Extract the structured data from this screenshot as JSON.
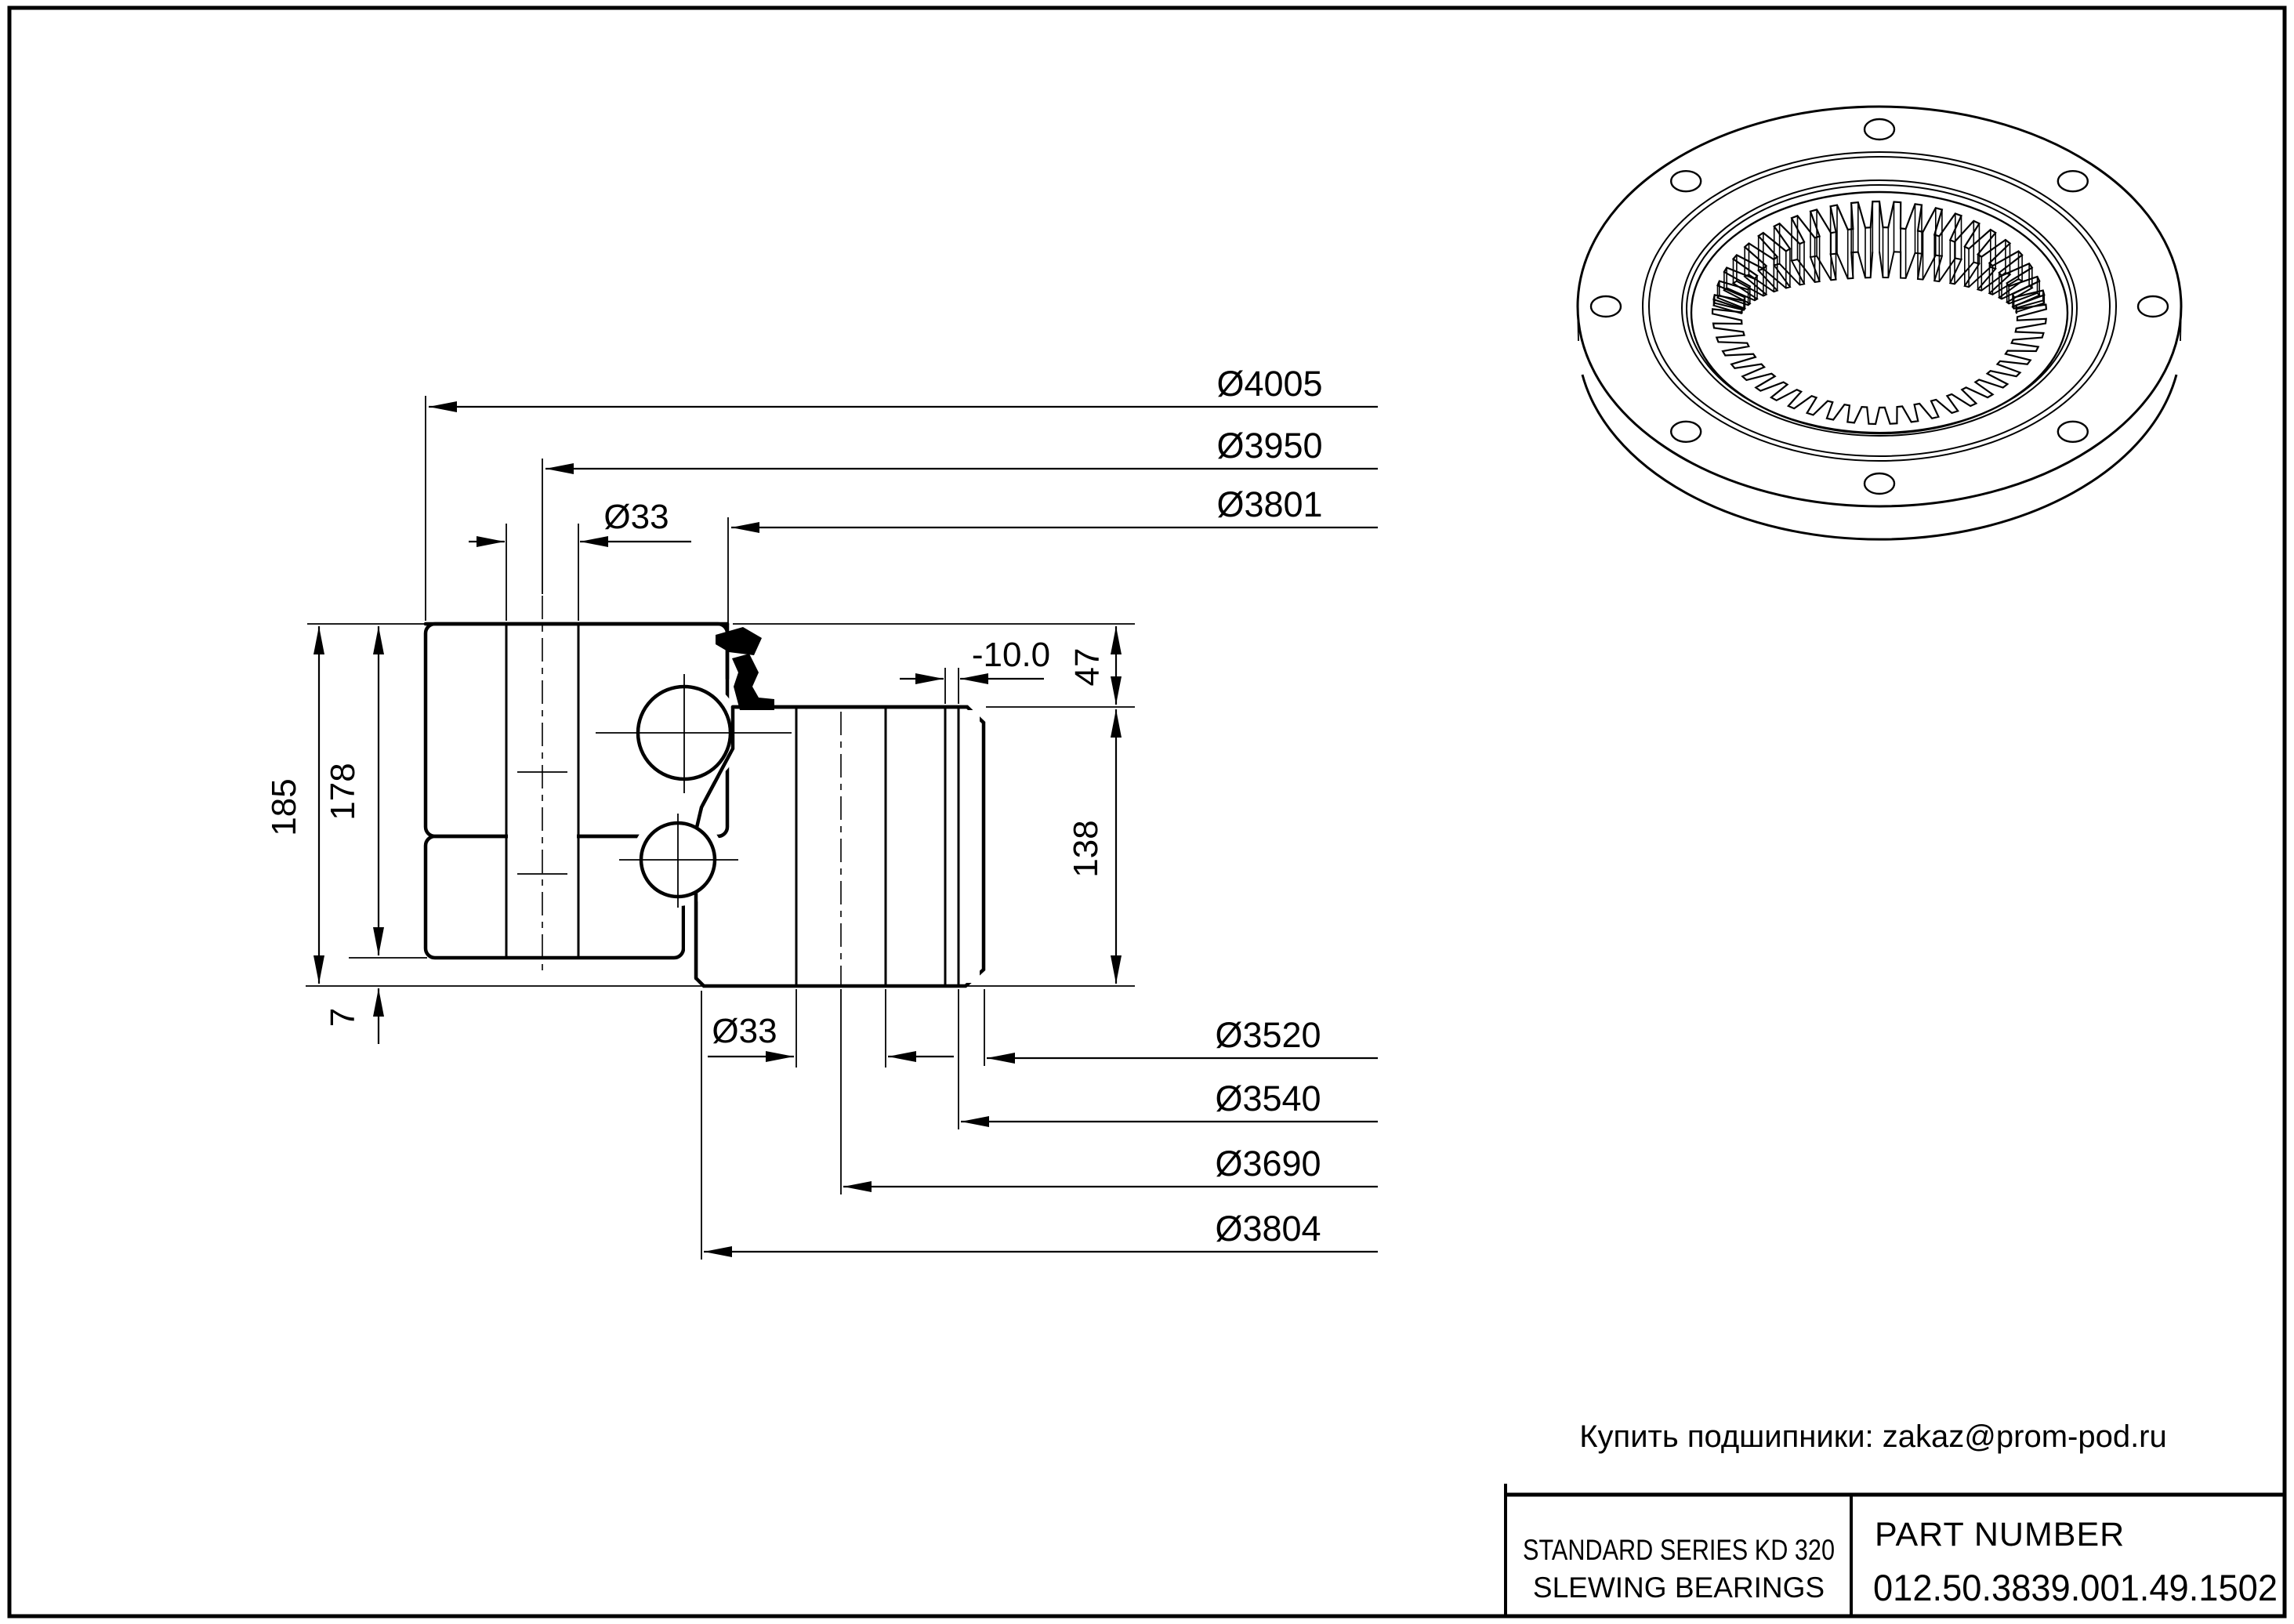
{
  "drawing": {
    "dims_top": {
      "d4005": "Ø4005",
      "d3950": "Ø3950",
      "d3801": "Ø3801",
      "d33_top": "Ø33"
    },
    "dims_right": {
      "d47": "47",
      "d10": "-10.0",
      "d138": "138"
    },
    "dims_left": {
      "d185": "185",
      "d178": "178",
      "d7": "7"
    },
    "dims_bottom": {
      "d33_bottom": "Ø33",
      "d3520": "Ø3520",
      "d3540": "Ø3540",
      "d3690": "Ø3690",
      "d3804": "Ø3804"
    }
  },
  "contact": {
    "text": "Купить подшипники: zakaz@prom-pod.ru"
  },
  "title_block": {
    "series_line1": "STANDARD SERIES KD 320",
    "series_line2": "SLEWING BEARINGS",
    "part_number_label": "PART  NUMBER",
    "part_number": "012.50.3839.001.49.1502"
  }
}
